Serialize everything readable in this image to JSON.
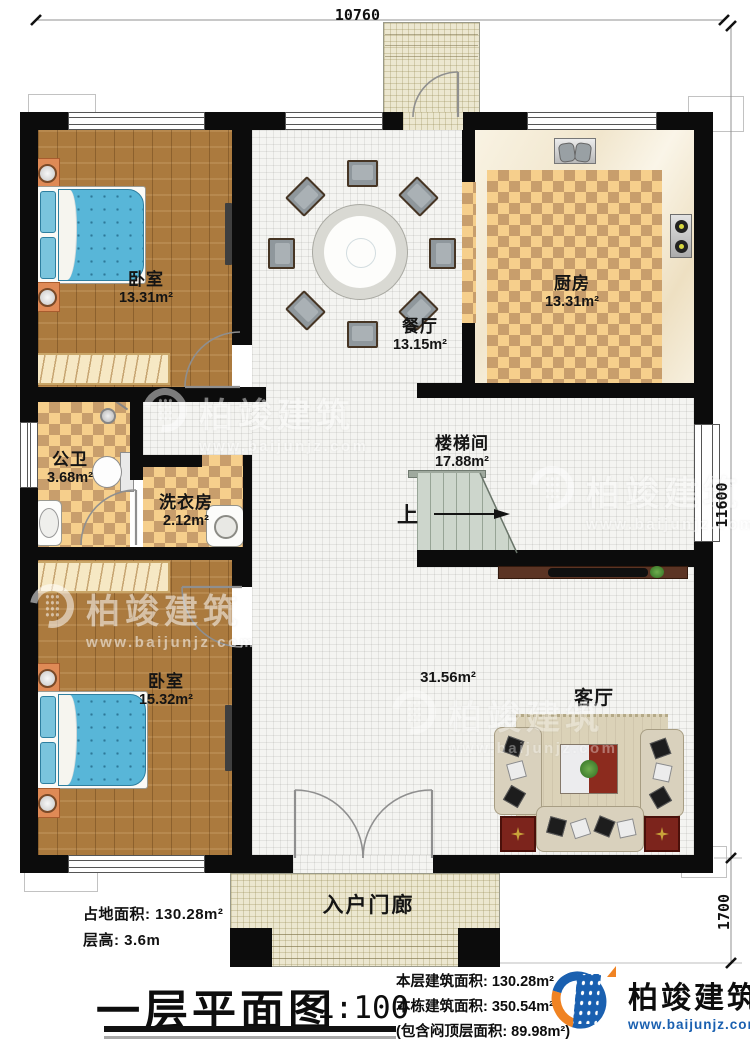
{
  "dimensions": {
    "top_width": "10760",
    "right_height": "11600",
    "porch_depth": "1700"
  },
  "rooms": {
    "bedroom_top": {
      "name": "卧室",
      "area": "13.31m²"
    },
    "dining": {
      "name": "餐厅",
      "area": "13.15m²"
    },
    "kitchen": {
      "name": "厨房",
      "area": "13.31m²"
    },
    "bathroom": {
      "name": "公卫",
      "area": "3.68m²"
    },
    "laundry": {
      "name": "洗衣房",
      "area": "2.12m²"
    },
    "stairwell": {
      "name": "楼梯间",
      "area": "17.88m²"
    },
    "bedroom_bottom": {
      "name": "卧室",
      "area": "15.32m²"
    },
    "living": {
      "name": "客厅",
      "area": "31.56m²"
    },
    "porch": {
      "name": "入户门廊"
    }
  },
  "stairs": {
    "up_label": "上"
  },
  "notes": {
    "footprint": "占地面积: 130.28m²",
    "floor_height": "层高: 3.6m"
  },
  "title_block": {
    "title": "一层平面图",
    "scale": "1:100",
    "floor_area_line": "本层建筑面积: 130.28m²",
    "building_area_line": "本栋建筑面积: 350.54m²",
    "attic_area_line": "(包含闷顶层面积: 89.98m²)"
  },
  "brand": {
    "name": "柏竣建筑",
    "url": "www.baijunjz.com"
  },
  "watermark": {
    "name": "柏竣建筑",
    "url": "www.baijunjz.com"
  },
  "colors": {
    "wall": "#0c0c0c",
    "wood": "#ab7a3e",
    "checker_light": "#f6cf8c",
    "checker_dark": "#c89e6c",
    "bed_blue": "#58b6d8",
    "stair_green": "#cdd6cc",
    "table_red": "#8c2b1e",
    "brand_blue": "#1a60b0",
    "brand_orange": "#f08323"
  }
}
